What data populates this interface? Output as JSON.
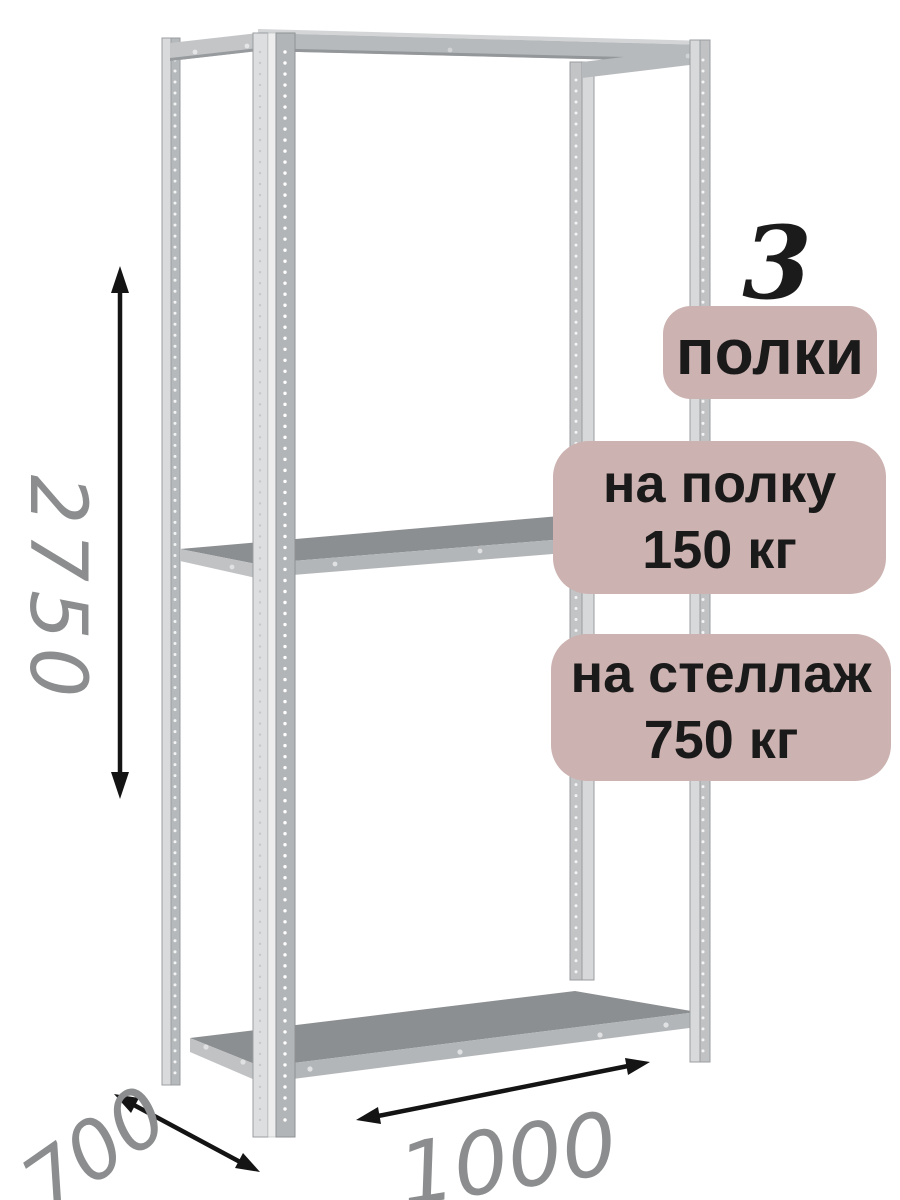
{
  "badges": {
    "count": "3",
    "count_label": "полки",
    "per_shelf": {
      "line1": "на полку",
      "line2": "150 кг"
    },
    "per_rack": {
      "line1": "на стеллаж",
      "line2": "750 кг"
    }
  },
  "dimensions": {
    "height_mm": "2750",
    "depth_mm": "700",
    "width_mm": "1000"
  },
  "colors": {
    "background": "#ffffff",
    "badge_background": "#ccb2b0",
    "badge_text": "#1a1a1a",
    "dimension_text": "#8b8d8e",
    "arrow": "#141414",
    "metal_light": "#dcdedf",
    "metal_mid": "#b3b6b8",
    "metal_dark": "#8c8f91"
  }
}
